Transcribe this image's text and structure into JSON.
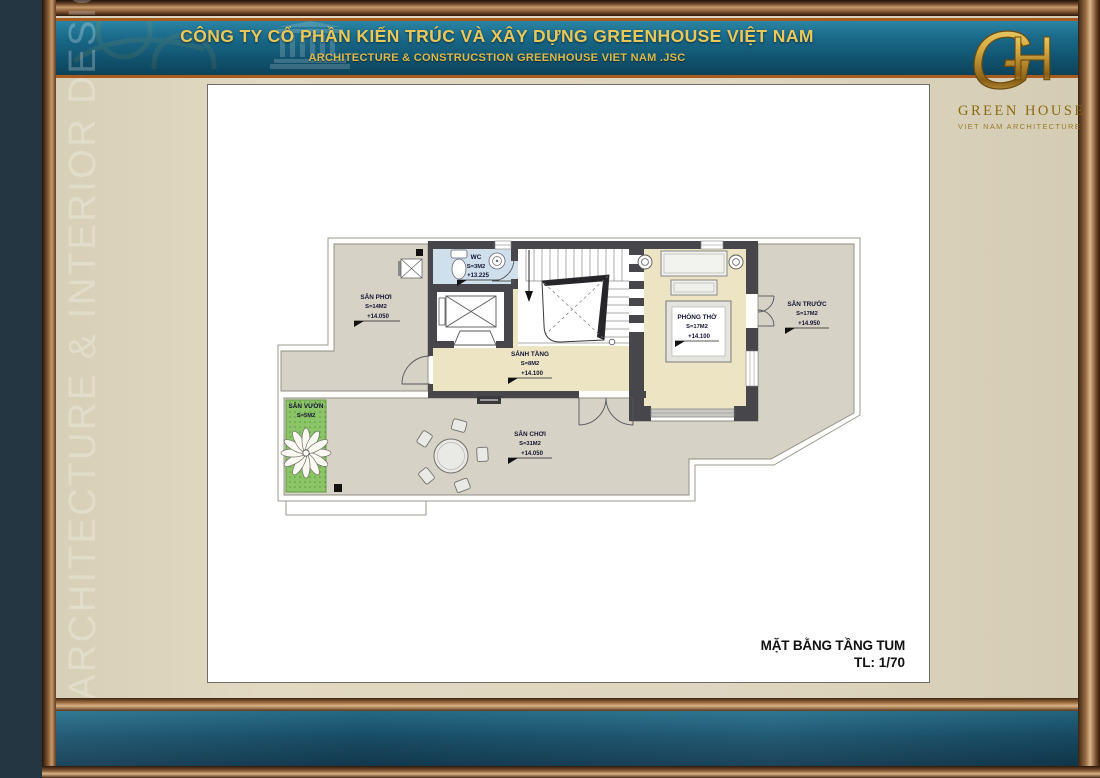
{
  "header": {
    "company_name_vi": "CÔNG TY CỔ PHẦN KIẾN TRÚC VÀ XÂY DỰNG GREENHOUSE VIỆT NAM",
    "company_name_en": "ARCHITECTURE & CONSTRUCSTION GREENHOUSE VIET NAM .JSC"
  },
  "logo": {
    "monogram": "GH",
    "name": "GREEN HOUSE",
    "tagline": "VIET NAM ARCHITECTURE"
  },
  "watermark": {
    "side_text": "ARCHITECTURE & INTERIOR DESIGN"
  },
  "title_block": {
    "drawing_title": "MẶT BẰNG TẦNG TUM",
    "scale": "TL: 1/70"
  },
  "floor_plan": {
    "rooms": [
      {
        "id": "san-phoi",
        "name": "SÂN PHƠI",
        "area": "S=14M2",
        "level": "+14.050"
      },
      {
        "id": "wc",
        "name": "WC",
        "area": "S=3M2",
        "level": "+13.225"
      },
      {
        "id": "sanh-tang",
        "name": "SẢNH TẦNG",
        "area": "S=8M2",
        "level": "+14.100"
      },
      {
        "id": "phong-tho",
        "name": "PHÒNG THỜ",
        "area": "S=17M2",
        "level": "+14.100"
      },
      {
        "id": "san-truoc",
        "name": "SÂN TRƯỚC",
        "area": "S=17M2",
        "level": "+14.950"
      },
      {
        "id": "san-choi",
        "name": "SÂN CHƠI",
        "area": "S=31M2",
        "level": "+14.050"
      },
      {
        "id": "san-vuon",
        "name": "SÂN VƯỜN",
        "area": "S=5M2",
        "level": ""
      }
    ]
  },
  "colors": {
    "background_beige": "#ded5bf",
    "header_teal": "#156a8c",
    "accent_gold": "#e8c85a",
    "frame_copper": "#9a6c44",
    "bottom_band_teal": "#1c5670",
    "terrace_floor": "#d6d2c6",
    "indoor_floor": "#ece4c2",
    "wc_floor": "#cfdfeb",
    "garden_green": "#8cc468",
    "wall_dark": "#47474b"
  }
}
